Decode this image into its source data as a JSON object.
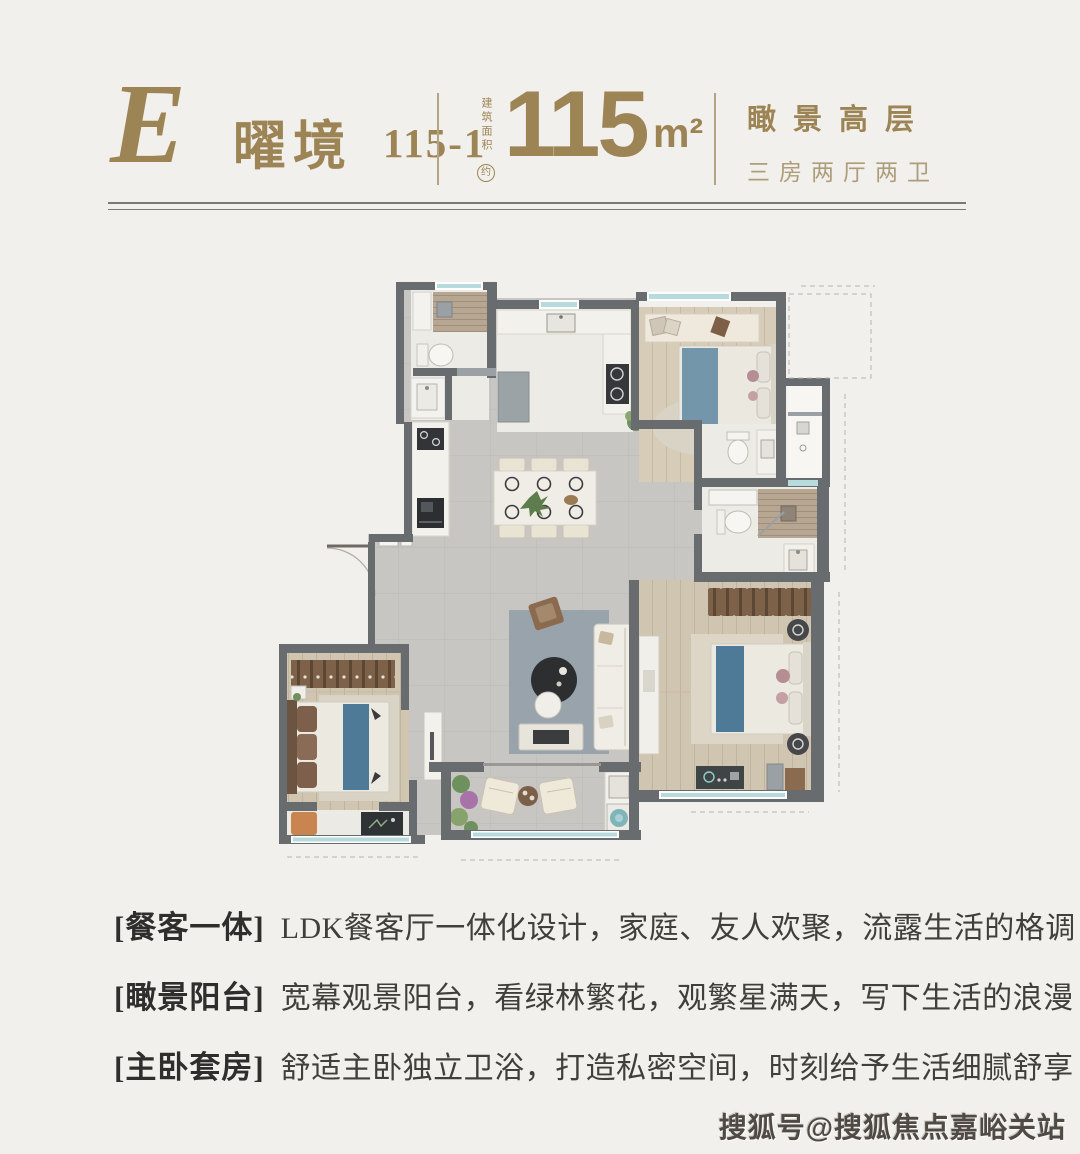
{
  "header": {
    "plan_letter": "E",
    "plan_name": "曜境",
    "plan_code": "115-1",
    "area_label": "建筑面积",
    "area_approx": "约",
    "area_value": "115",
    "area_unit": "m²",
    "feature_title": "瞰景高层",
    "feature_subtitle": "三房两厅两卫"
  },
  "features": [
    {
      "tag": "[餐客一体]",
      "text": "LDK餐客厅一体化设计，家庭、友人欢聚，流露生活的格调"
    },
    {
      "tag": "[瞰景阳台]",
      "text": "宽幕观景阳台，看绿林繁花，观繁星满天，写下生活的浪漫"
    },
    {
      "tag": "[主卧套房]",
      "text": "舒适主卧独立卫浴，打造私密空间，时刻给予生活细腻舒享"
    }
  ],
  "watermark": "搜狐号@搜狐焦点嘉峪关站",
  "palette": {
    "gold": "#9c8455",
    "gold_light": "#ae9d7a",
    "rule_line": "#7c7970",
    "body_text": "#413f3c",
    "watermark_text": "#4f4a44",
    "background": "#f2f0ec",
    "wall": "#686c6f",
    "floor_gray": "#c8c6c2",
    "floor_wood": "#d0c5b0",
    "floor_marble": "#ecebe6",
    "window_teal": "#b7dbdc",
    "bed_blue": "#5f86a0",
    "wardrobe_brown": "#7d6149",
    "rug_gray": "#98a3ac"
  }
}
